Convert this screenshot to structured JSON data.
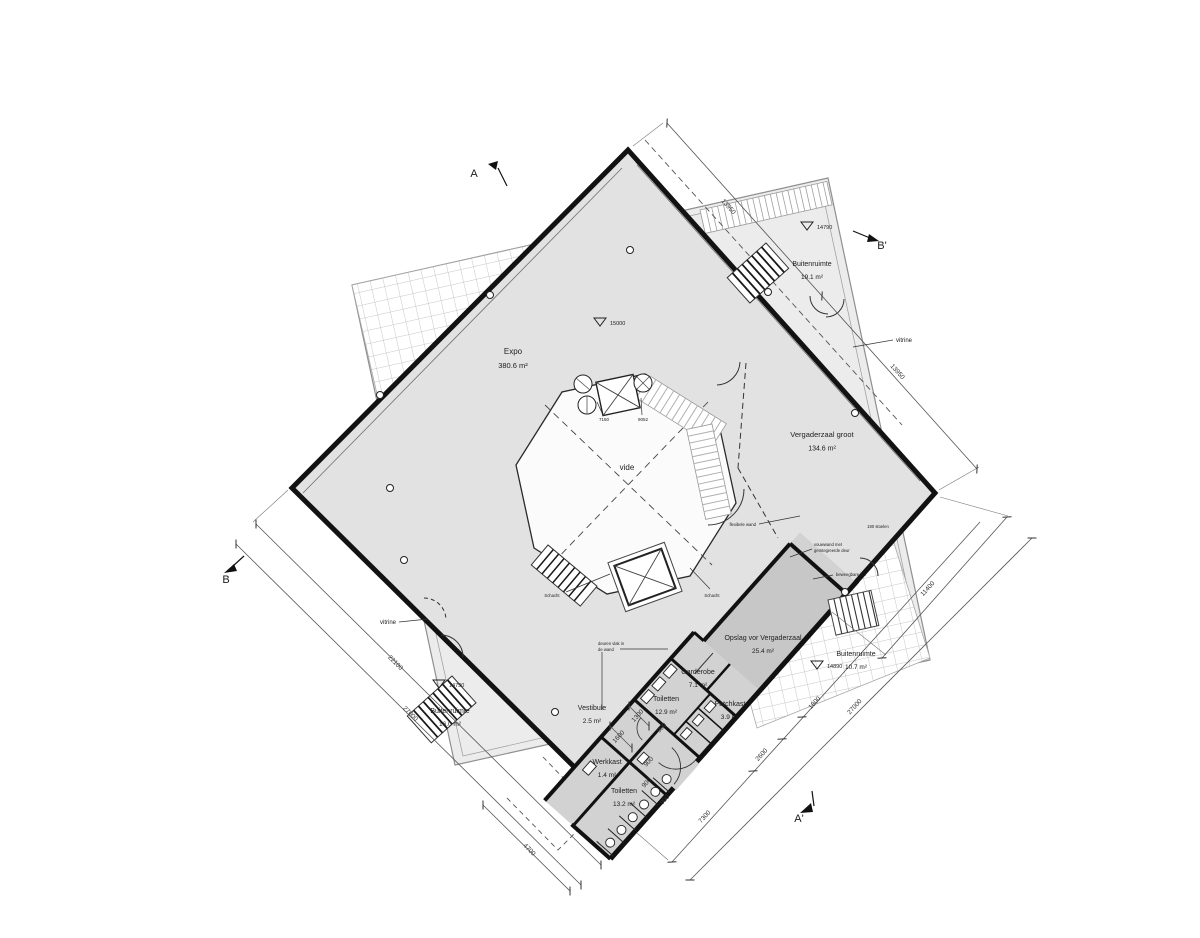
{
  "plan": {
    "rooms": [
      {
        "name": "Expo",
        "area": "380.6 m²",
        "x": 513,
        "y": 354,
        "size": 8
      },
      {
        "name": "Buitenruimte",
        "area": "19.1 m²",
        "x": 812,
        "y": 266,
        "size": 7
      },
      {
        "name": "Vergaderzaal groot",
        "area": "134.6 m²",
        "x": 822,
        "y": 437,
        "size": 7.5
      },
      {
        "name": "Opslag vor Vergaderzaal",
        "area": "25.4 m²",
        "x": 763,
        "y": 640,
        "size": 7
      },
      {
        "name": "Garderobe",
        "area": "7.1 m²",
        "x": 698,
        "y": 674,
        "size": 7
      },
      {
        "name": "Toiletten",
        "area": "12.9 m²",
        "x": 666,
        "y": 701,
        "size": 7
      },
      {
        "name": "Patchkast",
        "area": "3.9 m²",
        "x": 730,
        "y": 706,
        "size": 7
      },
      {
        "name": "Vestibule",
        "area": "2.5 m²",
        "x": 592,
        "y": 710,
        "size": 7
      },
      {
        "name": "Werkkast",
        "area": "1.4 m²",
        "x": 607,
        "y": 764,
        "size": 7
      },
      {
        "name": "Toiletten",
        "area": "13.2 m²",
        "x": 624,
        "y": 793,
        "size": 7
      },
      {
        "name": "Buitenruimte",
        "area": "16.0 m²",
        "x": 450,
        "y": 713,
        "size": 7
      },
      {
        "name": "Buitenruimte",
        "area": "10.7 m²",
        "x": 856,
        "y": 656,
        "size": 7
      }
    ],
    "annotations": [
      {
        "lines": [
          "vide"
        ],
        "x": 627,
        "y": 470,
        "size": 8,
        "anchor": "middle"
      },
      {
        "lines": [
          "vitrine"
        ],
        "x": 896,
        "y": 342,
        "size": 6,
        "anchor": "start"
      },
      {
        "lines": [
          "vitrine"
        ],
        "x": 396,
        "y": 624,
        "size": 6,
        "anchor": "end"
      },
      {
        "lines": [
          "Schacht"
        ],
        "x": 552,
        "y": 597,
        "size": 4.2,
        "anchor": "middle"
      },
      {
        "lines": [
          "Schacht"
        ],
        "x": 712,
        "y": 597,
        "size": 4.2,
        "anchor": "middle"
      },
      {
        "lines": [
          "flexibele wand"
        ],
        "x": 756,
        "y": 526,
        "size": 4.2,
        "anchor": "end"
      },
      {
        "lines": [
          "vouwwand met",
          "geïntegreerde deur"
        ],
        "x": 814,
        "y": 546,
        "size": 4.2,
        "anchor": "start"
      },
      {
        "lines": [
          "beweegbare bar"
        ],
        "x": 836,
        "y": 576,
        "size": 4.2,
        "anchor": "start"
      },
      {
        "lines": [
          "deuren vlak in",
          "de wand"
        ],
        "x": 598,
        "y": 645,
        "size": 4.2,
        "anchor": "start"
      },
      {
        "lines": [
          "180 stoelen"
        ],
        "x": 878,
        "y": 528,
        "size": 4.2,
        "anchor": "middle"
      },
      {
        "lines": [
          "7150"
        ],
        "x": 604,
        "y": 421,
        "size": 4.5,
        "anchor": "middle"
      },
      {
        "lines": [
          "9052"
        ],
        "x": 643,
        "y": 421,
        "size": 4.5,
        "anchor": "middle"
      }
    ],
    "levels": [
      {
        "value": "15000",
        "x": 600,
        "y": 318
      },
      {
        "value": "14790",
        "x": 807,
        "y": 222
      },
      {
        "value": "14790",
        "x": 439,
        "y": 680
      },
      {
        "value": "14890",
        "x": 817,
        "y": 661
      }
    ],
    "sections": [
      {
        "label": "A",
        "x": 474,
        "y": 177
      },
      {
        "label": "B'",
        "x": 882,
        "y": 249
      },
      {
        "label": "B",
        "x": 226,
        "y": 583
      },
      {
        "label": "A'",
        "x": 799,
        "y": 822
      }
    ],
    "dimensions": [
      {
        "text": "13950",
        "x": 727,
        "y": 208,
        "rot": 48
      },
      {
        "text": "13950",
        "x": 896,
        "y": 373,
        "rot": 48
      },
      {
        "text": "11400",
        "x": 929,
        "y": 590,
        "rot": -48
      },
      {
        "text": "27000",
        "x": 856,
        "y": 708,
        "rot": -48
      },
      {
        "text": "7300",
        "x": 706,
        "y": 818,
        "rot": -48
      },
      {
        "text": "2600",
        "x": 763,
        "y": 756,
        "rot": -48
      },
      {
        "text": "1800",
        "x": 816,
        "y": 704,
        "rot": -48
      },
      {
        "text": "22100",
        "x": 394,
        "y": 664,
        "rot": 45
      },
      {
        "text": "27000",
        "x": 409,
        "y": 715,
        "rot": 45
      },
      {
        "text": "4700",
        "x": 528,
        "y": 851,
        "rot": 45
      },
      {
        "text": "1600",
        "x": 620,
        "y": 738,
        "rot": -48
      },
      {
        "text": "1300",
        "x": 639,
        "y": 717,
        "rot": -48
      },
      {
        "text": "900",
        "x": 663,
        "y": 729,
        "rot": -48
      },
      {
        "text": "900",
        "x": 650,
        "y": 763,
        "rot": -48
      },
      {
        "text": "900",
        "x": 648,
        "y": 784,
        "rot": -48
      },
      {
        "text": "900",
        "x": 666,
        "y": 801,
        "rot": -48
      }
    ],
    "colors": {
      "floor": "#e2e2e2",
      "under_floor": "#ececec",
      "service": "#d2d2d2",
      "storage": "#c7c7c7",
      "line": "#141414"
    }
  }
}
